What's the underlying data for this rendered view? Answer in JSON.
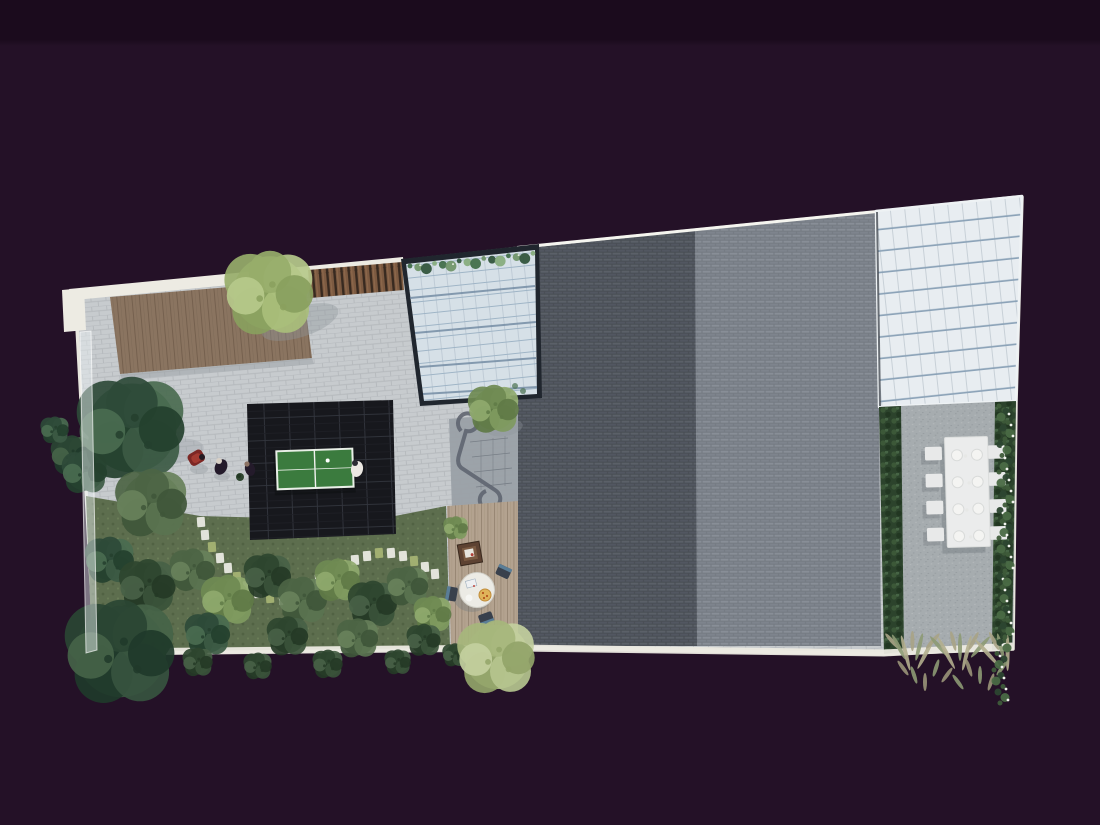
{
  "scene": {
    "type": "architectural-aerial-render",
    "regions": [
      "white-parapet-edge",
      "timber-deck",
      "stone-paving-terrace",
      "timber-slat-screen",
      "center-skylight",
      "skylight-vine",
      "dark-tiled-roof",
      "light-tiled-roof",
      "right-skylight",
      "gravel-dining-terrace",
      "boxwood-hedge",
      "flowering-hedge",
      "ornamental-grasses",
      "dining-table-for-eight",
      "table-tennis-court",
      "lawn-garden",
      "stepping-stone-path",
      "curved-planter-sculpture",
      "lower-deck-with-round-table",
      "glass-balustrade",
      "garden-trees"
    ],
    "counts": {
      "dining_chairs": 8,
      "dinner_plates": 8,
      "table_tennis_tables": 1,
      "skylights": 2,
      "people": 4,
      "round_table_chairs": 3
    }
  },
  "colors": {
    "background": "#241127",
    "background_top": "#1b0b1d",
    "parapet": "#edebe3",
    "paving": "#c7cbce",
    "paving_line": "#b5b9bd",
    "deck_wood": "#8a7460",
    "deck_wood_line": "#715d4b",
    "deck_wood_grain": "#7e6a57",
    "slat_wood": "#7c5a41",
    "slat_gap": "#382a20",
    "lawn": "#5d6e4e",
    "lawn_dark": "#516243",
    "lawn_light": "#6a7d57",
    "stone": "#e9e9e1",
    "stone_moss": "#a4b273",
    "court_tile": "#17181d",
    "court_line": "#33363e",
    "table_tennis": "#3b7b3e",
    "table_tennis_line": "#e9efe7",
    "ball": "#ffffff",
    "roof_dark": "#4a4f56",
    "roof_dark_brick": "#5b6068",
    "roof_dark_brick2": "#525761",
    "roof_light": "#767c84",
    "roof_light_brick": "#888e97",
    "roof_light_brick2": "#7e848d",
    "roof_edge_highlight": "#f5f5ef",
    "glass_frame": "#20262e",
    "glass_center": "#d6e0e7",
    "glass_center_vline": "#bcc8d3",
    "glass_center_line": "#9db3c5",
    "glass_center_bar": "#6e87a0",
    "glass_right": "#e8edf1",
    "glass_right_line": "#c6cfd6",
    "glass_right_bar": "#8ca3b8",
    "gravel": "#a6acaf",
    "gravel_line": "#979da1",
    "gravel_light": "#b4b9bb",
    "hedge": "#2c432c",
    "hedge_light": "#3c5838",
    "flower": "#f2f4ee",
    "dining_table": "#ebecec",
    "chair": "#e8e9e9",
    "plate": "#f4f4f2",
    "furniture_shadow": "#6f757a",
    "deck_light": "#b3a28f",
    "deck_light_line": "#93826f",
    "round_table": "#ecebe5",
    "pizza": "#e0b35a",
    "pepperoni": "#b5541f",
    "chair_dark": "#39404c",
    "chair_accent": "#5a7d96",
    "crate": "#5d4232",
    "sculpture": "#9aa0a7",
    "sculpture_line": "#5f6570",
    "person_red": "#7d2724",
    "person_dark": "#241b2b",
    "balustrade": "rgba(236,242,244,0.45)"
  }
}
